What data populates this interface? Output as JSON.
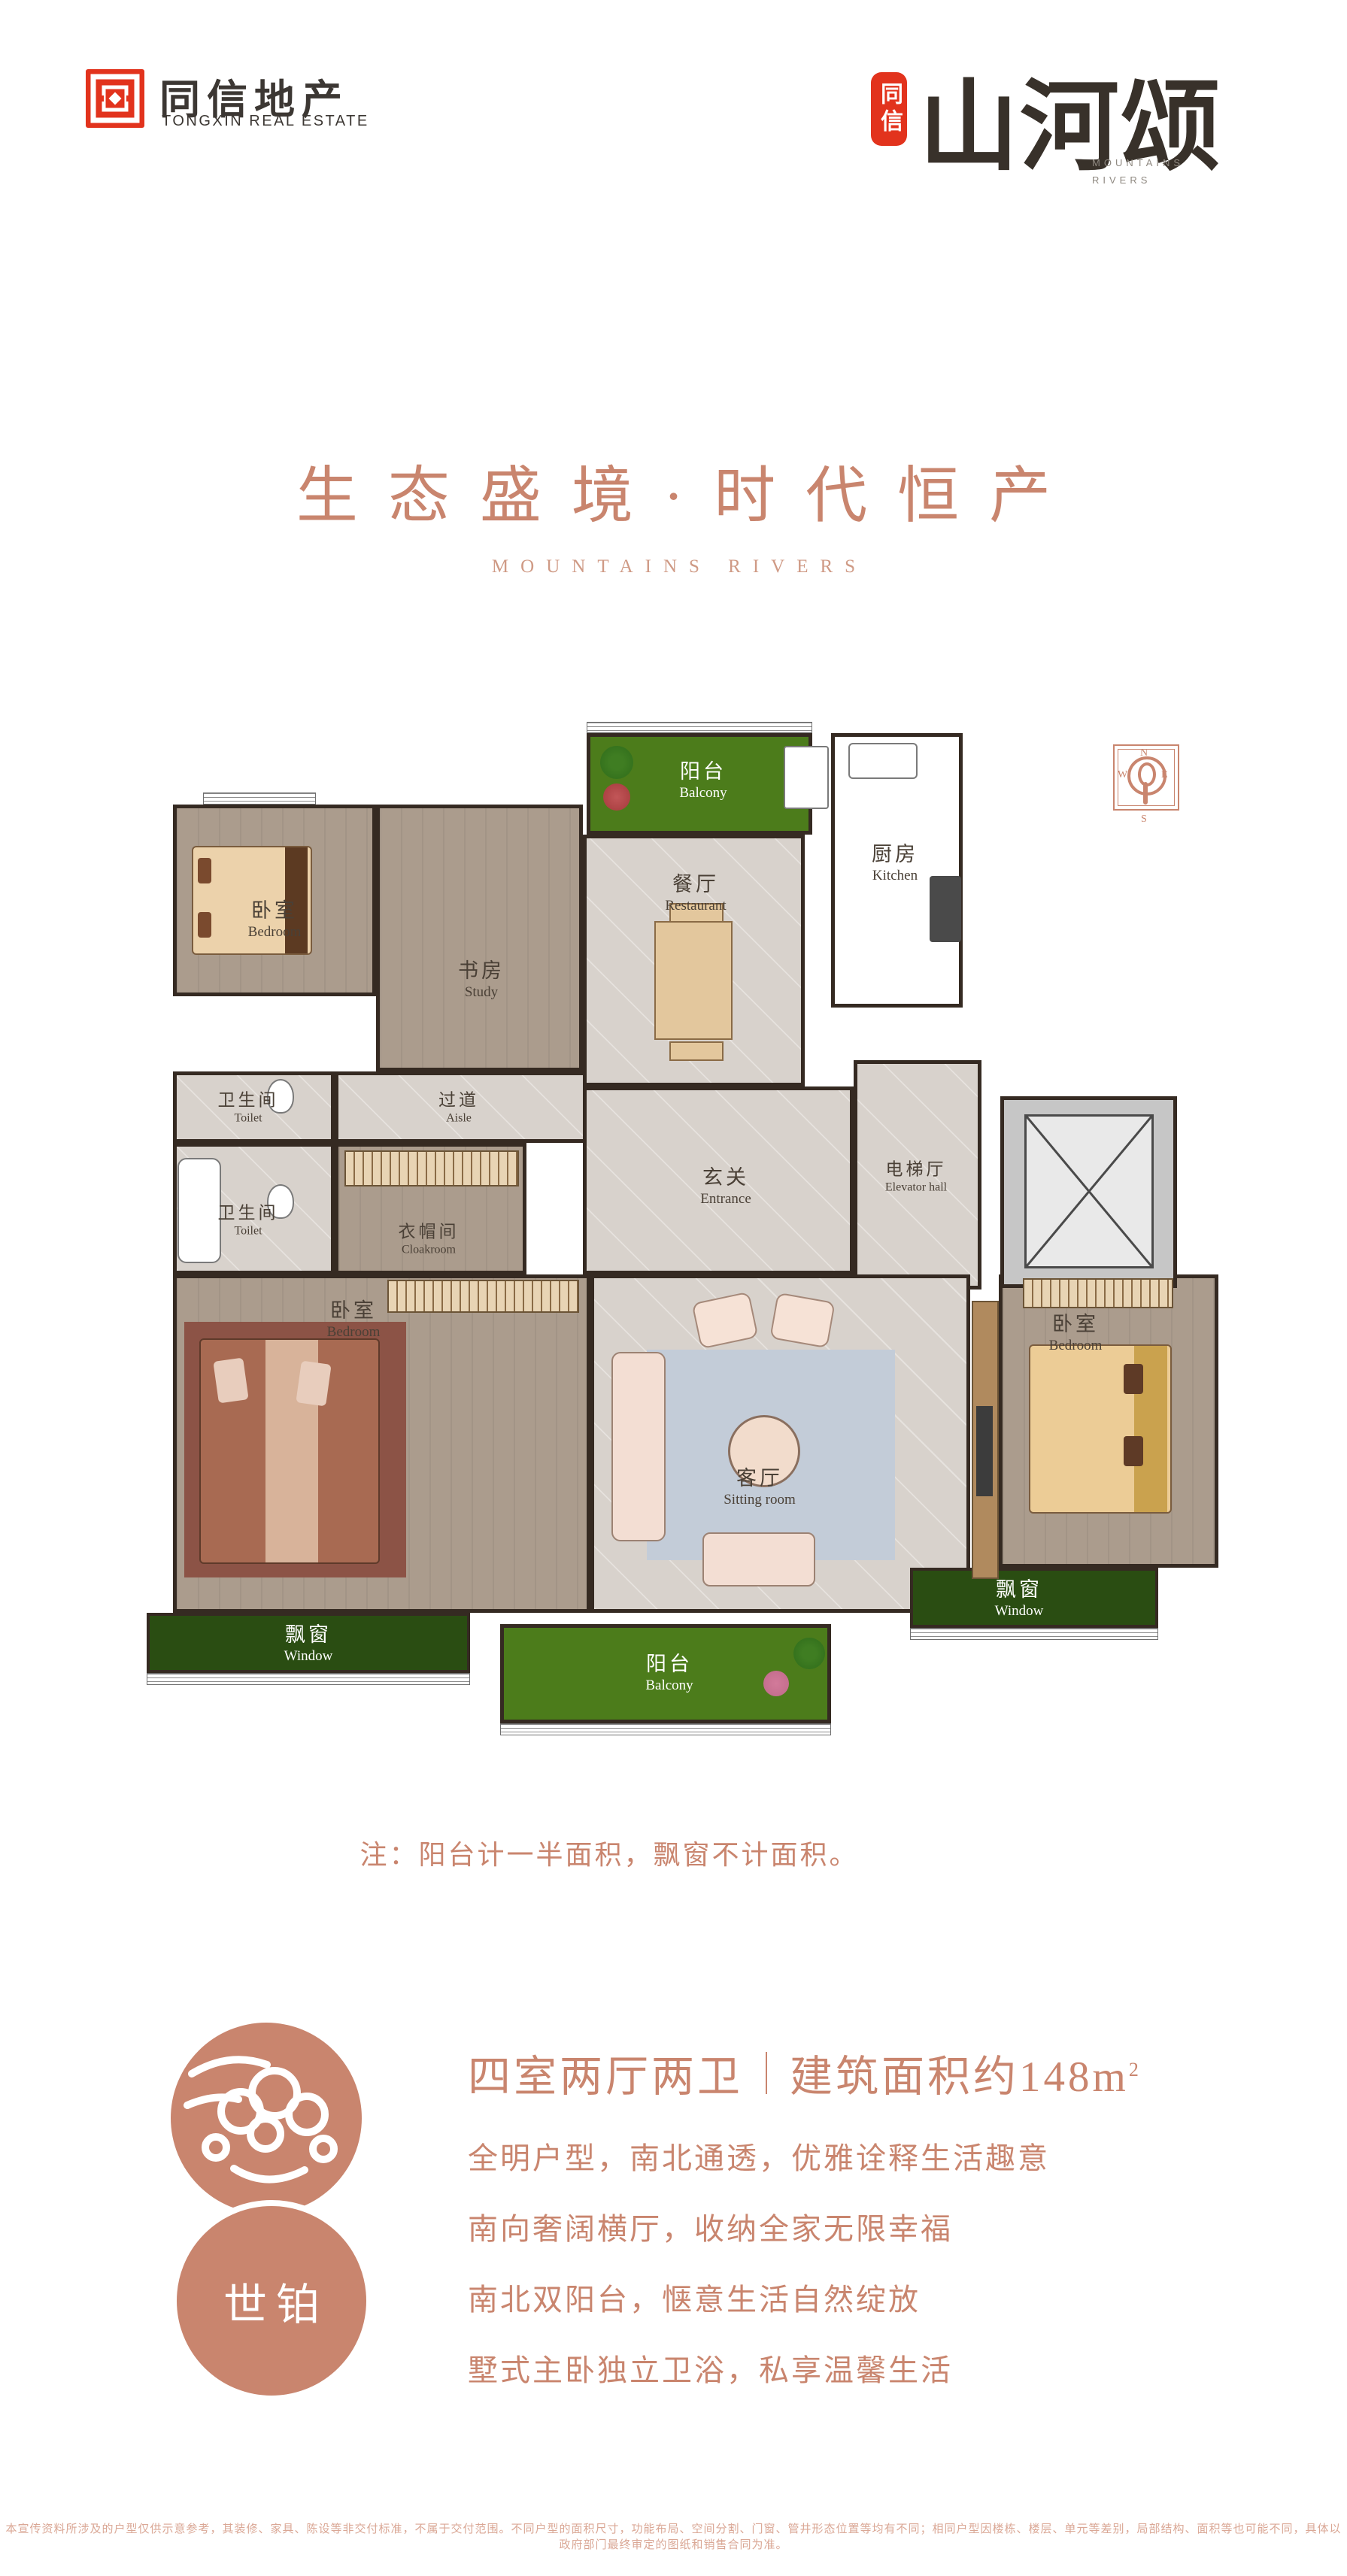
{
  "header": {
    "logo": {
      "zh": "同信地产",
      "en": "TONGXIN REAL ESTATE"
    },
    "brand": {
      "seal": "同信",
      "name": "山河颂",
      "en_line1": "MOUNTAINS",
      "en_line2": "RIVERS"
    }
  },
  "hero": {
    "title": "生态盛境·时代恒产",
    "subtitle": "MOUNTAINS RIVERS"
  },
  "floorplan": {
    "compass": {
      "n": "N",
      "e": "E",
      "s": "S",
      "w": "W"
    },
    "rooms": [
      {
        "id": "bedroom-north",
        "zh": "卧室",
        "en": "Bedroom"
      },
      {
        "id": "study",
        "zh": "书房",
        "en": "Study"
      },
      {
        "id": "balcony-north",
        "zh": "阳台",
        "en": "Balcony"
      },
      {
        "id": "kitchen",
        "zh": "厨房",
        "en": "Kitchen"
      },
      {
        "id": "restaurant",
        "zh": "餐厅",
        "en": "Restaurant"
      },
      {
        "id": "toilet-north",
        "zh": "卫生间",
        "en": "Toilet"
      },
      {
        "id": "aisle",
        "zh": "过道",
        "en": "Aisle"
      },
      {
        "id": "toilet-south",
        "zh": "卫生间",
        "en": "Toilet"
      },
      {
        "id": "cloakroom",
        "zh": "衣帽间",
        "en": "Cloakroom"
      },
      {
        "id": "entrance",
        "zh": "玄关",
        "en": "Entrance"
      },
      {
        "id": "elevator-hall",
        "zh": "电梯厅",
        "en": "Elevator hall"
      },
      {
        "id": "master-bedroom",
        "zh": "卧室",
        "en": "Bedroom"
      },
      {
        "id": "sitting-room",
        "zh": "客厅",
        "en": "Sitting room"
      },
      {
        "id": "bedroom-east",
        "zh": "卧室",
        "en": "Bedroom"
      },
      {
        "id": "window-west",
        "zh": "飘窗",
        "en": "Window"
      },
      {
        "id": "balcony-south",
        "zh": "阳台",
        "en": "Balcony"
      },
      {
        "id": "window-east",
        "zh": "飘窗",
        "en": "Window"
      }
    ]
  },
  "note": "注：阳台计一半面积，飘窗不计面积。",
  "info": {
    "badge": "世铂",
    "title_left": "四室两厅两卫",
    "title_right": "建筑面积约148m",
    "title_sup": "2",
    "bullets": [
      "全明户型，南北通透，优雅诠释生活趣意",
      "南向奢阔横厅，收纳全家无限幸福",
      "南北双阳台，惬意生活自然绽放",
      "墅式主卧独立卫浴，私享温馨生活"
    ]
  },
  "disclaimer": "本宣传资料所涉及的户型仅供示意参考，其装修、家具、陈设等非交付标准，不属于交付范围。不同户型的面积尺寸，功能布局、空间分割、门窗、管井形态位置等均有不同；相同户型因楼栋、楼层、单元等差别，局部结构、面积等也可能不同，具体以政府部门最终审定的图纸和销售合同为准。",
  "colors": {
    "accent": "#c9856e",
    "logo_red": "#e2331d",
    "wall": "#352a22",
    "grass": "#4c7c1b",
    "window_green": "#2a4d12"
  }
}
